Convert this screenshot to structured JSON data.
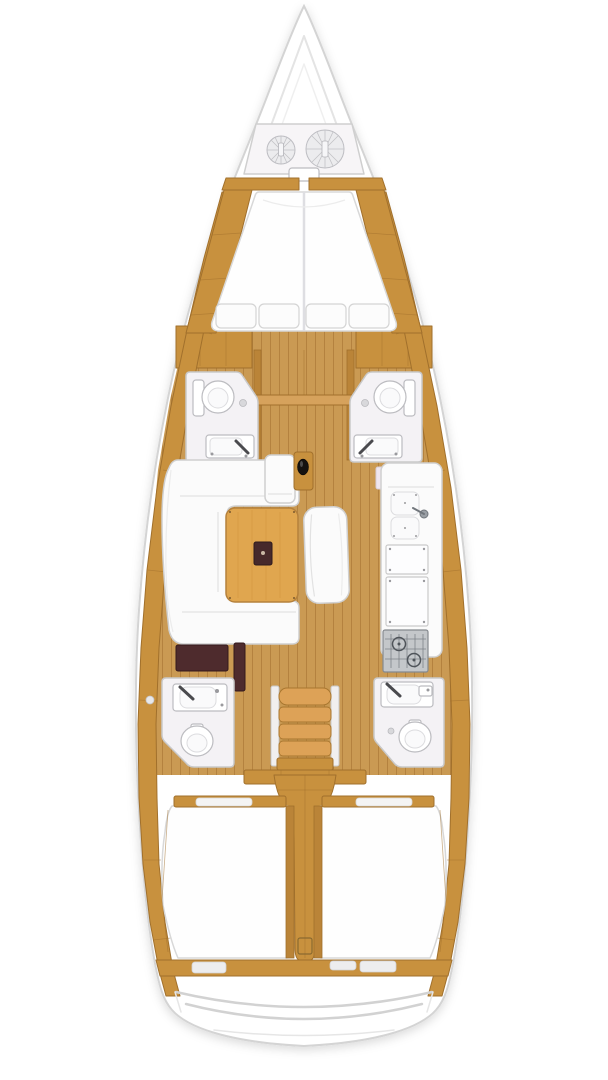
{
  "meta": {
    "title": "Sailboat interior deck plan (top-down)",
    "type": "yacht-floorplan",
    "orientation": "bow-up"
  },
  "colors": {
    "bg": "#ffffff",
    "hull_fill": "#ffffff",
    "hull_stroke": "#d4d4d4",
    "deck_line": "#e4e4e4",
    "wood": "#c8913e",
    "wood_dark": "#a1702c",
    "wood_mid": "#ba8438",
    "wood_beam": "#d6a25c",
    "floor": "#ca9a53",
    "floor_seam": "#b4823f",
    "table": "#e0a64f",
    "table_edge": "#b5813c",
    "table_insert": "#46292b",
    "seat_white": "#fbfbfb",
    "furniture_stroke": "#d0d0d0",
    "room": "#f4f2f5",
    "room_stroke": "#c9c9c9",
    "fixture_stroke": "#bcbcc0",
    "dark_seat": "#4e2b2d",
    "stove": "#c4c7ca",
    "stove_grid": "#6e7278",
    "rope": "#ececee",
    "rope_line": "#c2c2c6",
    "stairs_wood": "#dda257",
    "stairs_stroke": "#a8762f",
    "berth_white": "#fefefe",
    "mattress_stroke": "#d8d8d8",
    "pad_gray": "#ededee"
  },
  "features": {
    "hull": {
      "label": "Sailboat hull, top-down view, bow at top"
    },
    "anchor_locker": {
      "label": "Bow anchor locker with two rope coils",
      "rope_coils": 2
    },
    "v_berth": {
      "label": "Forward V-berth double cabin",
      "pillows": 4
    },
    "forward_head_port": {
      "label": "Forward port bathroom with toilet and sink"
    },
    "forward_head_starboard": {
      "label": "Forward starboard bathroom with toilet and sink"
    },
    "saloon_settee": {
      "label": "U-shaped saloon settee"
    },
    "saloon_table": {
      "label": "Wooden saloon table with dark inlay"
    },
    "island_bench": {
      "label": "Saloon island bench"
    },
    "mast": {
      "label": "Mast post with wooden collar"
    },
    "galley": {
      "label": "Galley with double sink, worktop lockers and stove",
      "sink_basins": 2,
      "stove_burners": 2
    },
    "nav_seat": {
      "label": "Navigation seat"
    },
    "companionway_steps": {
      "label": "Companionway steps",
      "steps": 4
    },
    "aft_head_port": {
      "label": "Aft port bathroom with sink and toilet"
    },
    "aft_head_starboard": {
      "label": "Aft starboard bathroom with sink and toilet"
    },
    "aft_cabin_port": {
      "label": "Aft port double cabin berth"
    },
    "aft_cabin_starboard": {
      "label": "Aft starboard double cabin berth"
    },
    "engine_compartment": {
      "label": "Engine compartment and companionway trunk"
    },
    "transom": {
      "label": "Stern transom with swim platform steps"
    }
  }
}
